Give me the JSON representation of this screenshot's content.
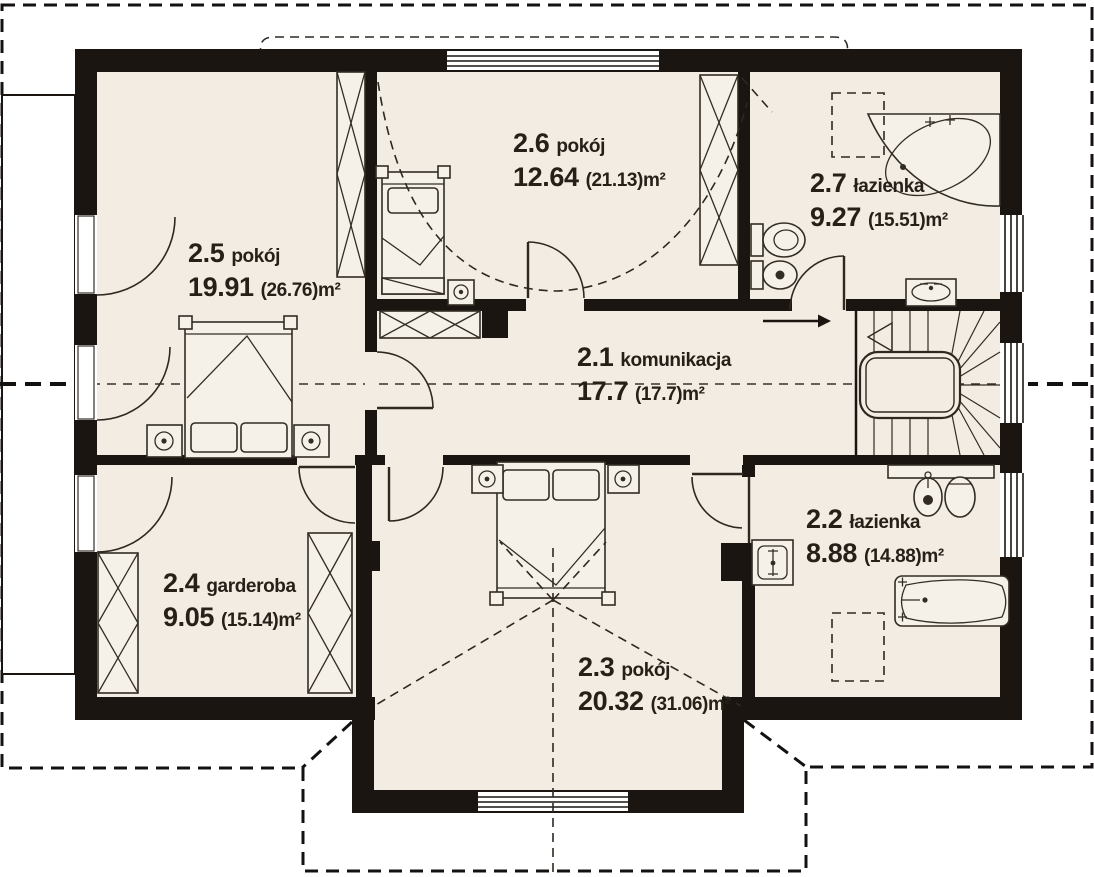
{
  "plan": {
    "type": "floor-plan",
    "level_prefix": "2",
    "rooms": [
      {
        "id": "2.1",
        "name": "komunikacja",
        "area": "17.7",
        "area_total": "(17.7)m²"
      },
      {
        "id": "2.2",
        "name": "łazienka",
        "area": "8.88",
        "area_total": "(14.88)m²"
      },
      {
        "id": "2.3",
        "name": "pokój",
        "area": "20.32",
        "area_total": "(31.06)m²"
      },
      {
        "id": "2.4",
        "name": "garderoba",
        "area": "9.05",
        "area_total": "(15.14)m²"
      },
      {
        "id": "2.5",
        "name": "pokój",
        "area": "19.91",
        "area_total": "(26.76)m²"
      },
      {
        "id": "2.6",
        "name": "pokój",
        "area": "12.64",
        "area_total": "(21.13)m²"
      },
      {
        "id": "2.7",
        "name": "łazienka",
        "area": "9.27",
        "area_total": "(15.51)m²"
      }
    ],
    "colors": {
      "floor": "#f2ece2",
      "wall": "#1a1511",
      "line": "#332c24",
      "text": "#262019",
      "background": "#ffffff"
    },
    "symbols": [
      "double-bed",
      "single-bed",
      "wardrobe",
      "nightstand",
      "toilet",
      "bidet",
      "corner-bathtub",
      "bathtub",
      "washbasin",
      "stairs",
      "roof-window",
      "section-line",
      "roof-outline",
      "balcony"
    ]
  }
}
